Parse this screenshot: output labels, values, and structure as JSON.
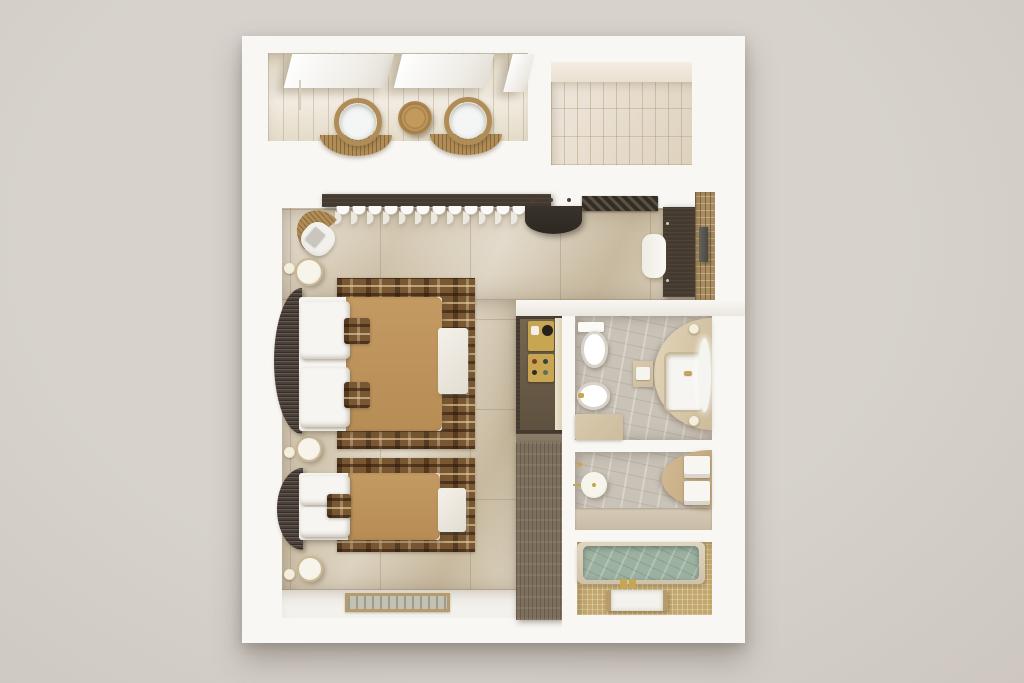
{
  "scene": {
    "type": "3d-floorplan-top-view-render",
    "description": "Photorealistic top-down 3D render of a hotel suite floor plan: terrace with two papasan chairs and side table, tiled entrance patio, bedroom with one double bed and one single bed on patterned rugs, entry console and desk with mosaic TV wall, tall wardrobe with minibar niche, and a bathroom wing with WC/bidet/vanity room, shower room and sunken bathtub room",
    "rooms": [
      {
        "name": "terrace",
        "items": [
          "awning",
          "awning",
          "awning",
          "papasan-chair",
          "round-side-table",
          "papasan-chair"
        ]
      },
      {
        "name": "entrance-patio",
        "items": [
          "plank-tile-floor"
        ]
      },
      {
        "name": "bedroom",
        "items": [
          "curtain-pelmet",
          "sheer-curtain",
          "armchair-with-throw",
          "wall-sconce",
          "nightstand",
          "double-bed",
          "area-rug",
          "foot-bench",
          "wall-sconce",
          "nightstand",
          "single-bed",
          "area-rug",
          "foot-bench",
          "wall-sconce",
          "nightstand",
          "entry-doormat"
        ]
      },
      {
        "name": "entry-hall",
        "items": [
          "coat-hooks",
          "half-round-console",
          "striped-door-mat",
          "desk",
          "desk-chair",
          "mosaic-accent-wall",
          "wall-tv",
          "wardrobe-minibar-niche",
          "kettle-tray",
          "minibar-tray",
          "open-door-panel",
          "wardrobe-lower-cabinet"
        ]
      },
      {
        "name": "bathroom-wc",
        "items": [
          "toilet",
          "bidet",
          "travertine-bench",
          "vanity-counter",
          "inset-sink",
          "gold-faucet",
          "led-oval-mirror",
          "wall-sconce",
          "wall-sconce",
          "stool-with-towel"
        ]
      },
      {
        "name": "shower-room",
        "items": [
          "rain-shower-head",
          "shower-arm",
          "hand-shower",
          "curved-counter",
          "towel-stack",
          "towel-stack",
          "travertine-threshold"
        ]
      },
      {
        "name": "bathtub-room",
        "items": [
          "gold-mosaic-floor",
          "bathtub-green-marble",
          "gold-taps",
          "white-bath-tray"
        ]
      }
    ]
  },
  "palette": {
    "bg": "#d7d2cc",
    "bgEdge": "#cdc7c0",
    "wall": "#f9f7f3",
    "wallShade": "#eae6df",
    "terraceFloor": "#eee7da",
    "tileFloor": "#e9dfd0",
    "trav": "#d5c9b3",
    "hallFloor": "#f3f1ec",
    "rugBase": "#7a5733",
    "duvet": "#c49a63",
    "pillow": "#f7f5f1",
    "headboard": "#4b4039",
    "bench": "#f0ede6",
    "woodDark": "#453a2f",
    "woodNiche": "#6e5f4e",
    "woodLight": "#7d6f5d",
    "gold": "#c8a550",
    "creamDoor": "#ebe3cd",
    "rattan": "#b08d57",
    "bathFloor": "#c9c2b7",
    "vanityStone": "#d8c9ad",
    "fixture": "#fbfaf7",
    "tubGreen": "#9db1a1",
    "tubRim": "#d8ccb5",
    "goldFloor": "#c2a76e",
    "mosaic": "#a98d60",
    "tv": "#55514b",
    "matDark": "#332d25",
    "matStripe": "#5a5240",
    "dmBorder": "#b89b6b",
    "dmInner": "#c3c2b2",
    "nsRim": "#cbb791"
  }
}
